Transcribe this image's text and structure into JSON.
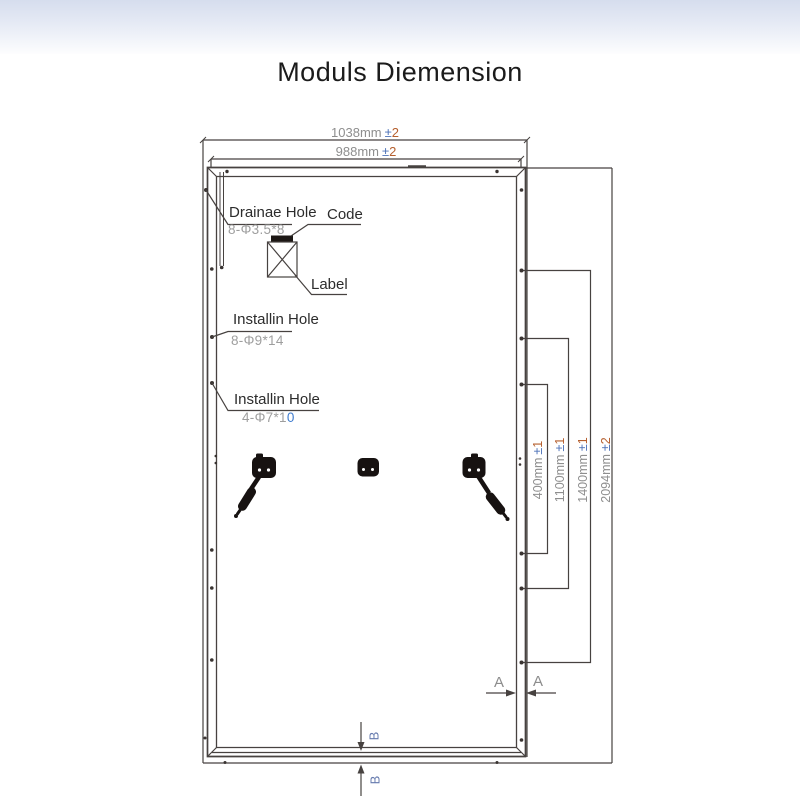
{
  "title": "Moduls Diemension",
  "colors": {
    "line": "#474240",
    "dim_text": "#8e8e8e",
    "tolerance_sign": "#4d72b8",
    "tolerance_value": "#b55f2e",
    "callout_text": "#2c2c2c",
    "spec_text": "#9e9e9e",
    "accent_blue": "#3f7ccf",
    "section_b": "#6479ad",
    "header_gradient_top": "#d6ddee"
  },
  "dimensions": {
    "width_outer": {
      "value": "1038mm",
      "sign": "±",
      "tol": "2"
    },
    "width_inner": {
      "value": "988mm",
      "sign": "±",
      "tol": "2"
    },
    "height_400": {
      "value": "400mm",
      "sign": "±",
      "tol": "1"
    },
    "height_1100": {
      "value": "1100mm",
      "sign": "±",
      "tol": "1"
    },
    "height_1400": {
      "value": "1400mm",
      "sign": "±",
      "tol": "1"
    },
    "height_overall": {
      "value": "2094mm",
      "sign": "±",
      "tol": "2"
    }
  },
  "callouts": {
    "drainage": {
      "title": "Drainae Hole",
      "spec": "8-Φ3.5*8"
    },
    "code": {
      "title": "Code"
    },
    "label": {
      "title": "Label"
    },
    "install_upper": {
      "title": "Installin Hole",
      "spec": "8-Φ9*14"
    },
    "install_lower": {
      "title": "Installin Hole",
      "spec": "4-Φ7*1",
      "spec_tail": "0"
    }
  },
  "sections": {
    "a": "A",
    "b": "B"
  }
}
